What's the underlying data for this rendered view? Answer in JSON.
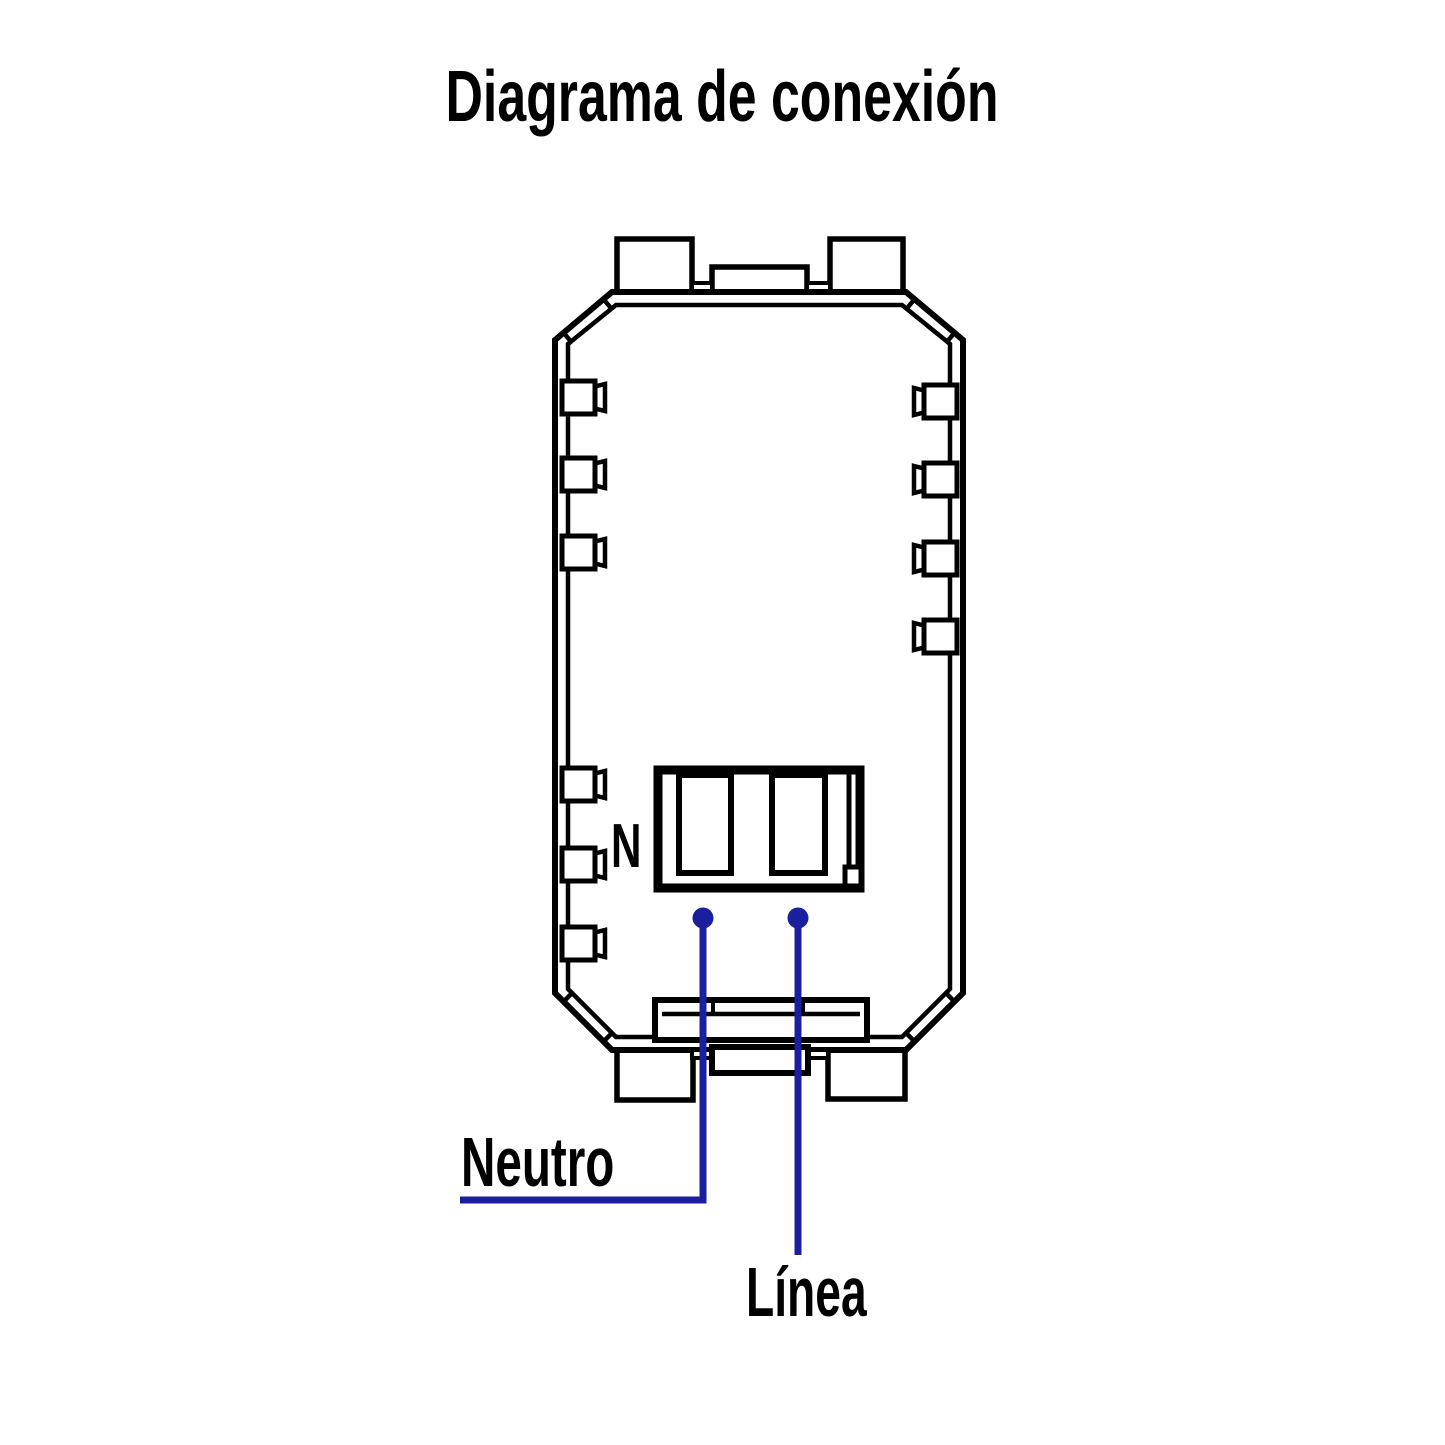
{
  "title": "Diagrama de conexión",
  "diagram": {
    "terminal_label": "N",
    "wire_labels": {
      "neutral": "Neutro",
      "line": "Línea"
    },
    "colors": {
      "outline": "#000000",
      "wire": "#1b1f9e",
      "background": "#ffffff",
      "text": "#000000"
    }
  }
}
